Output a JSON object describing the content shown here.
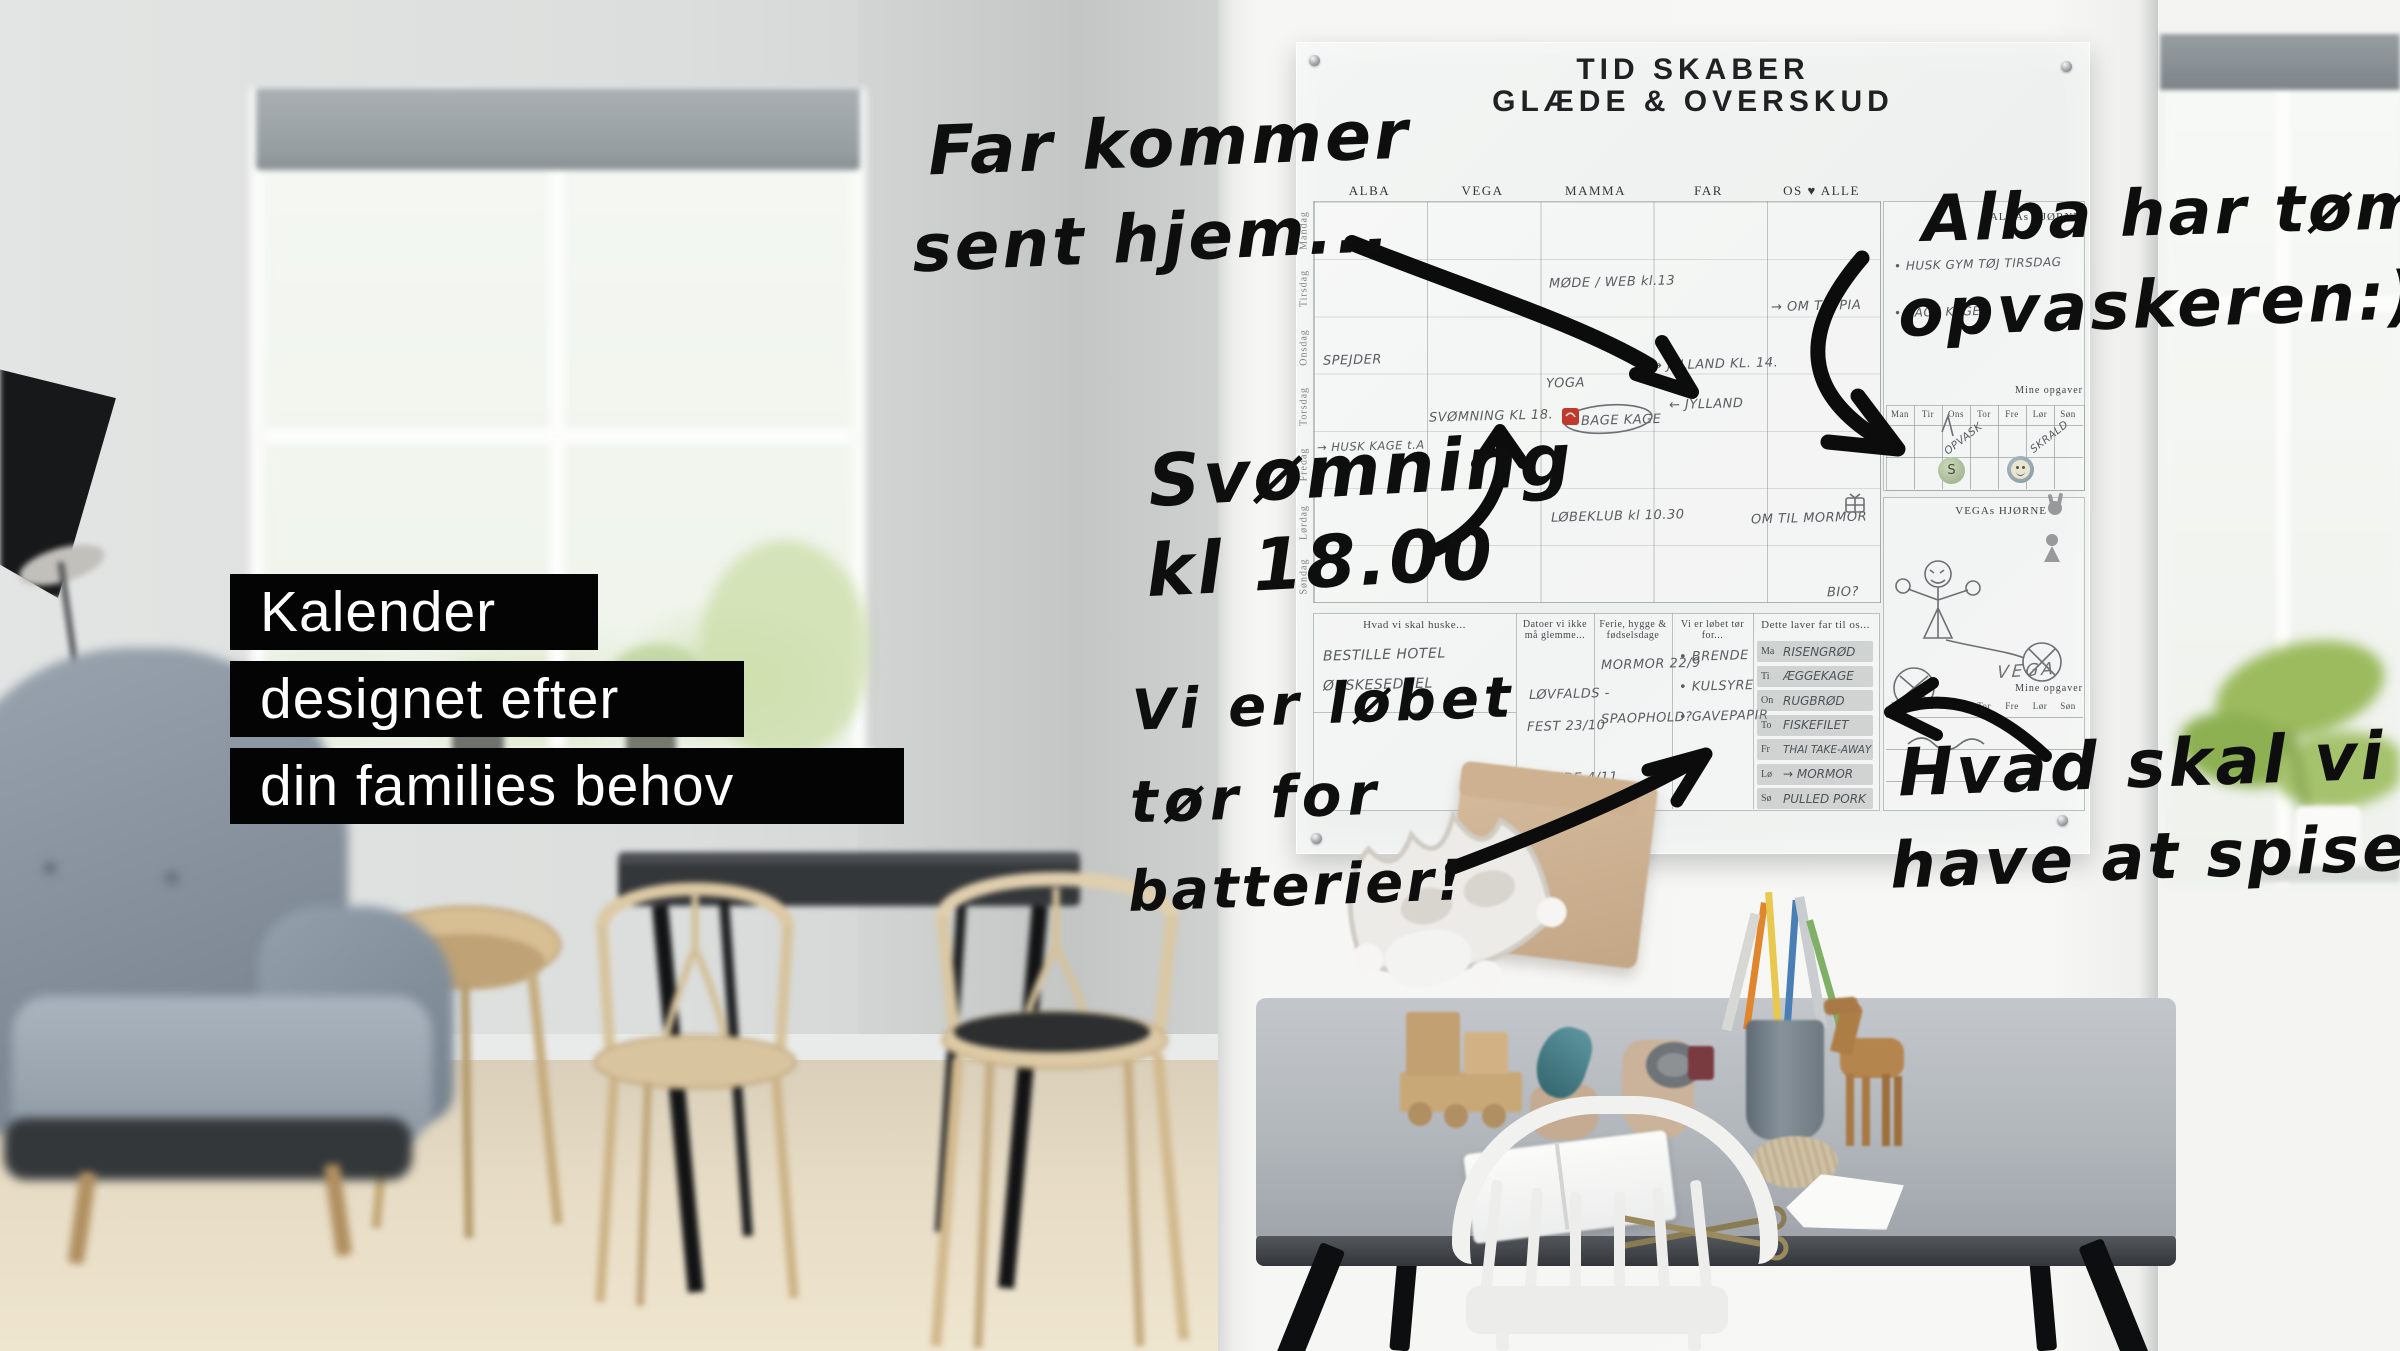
{
  "overlay": {
    "headline": [
      "Kalender",
      "designet efter",
      "din families behov"
    ]
  },
  "annotations": {
    "far": [
      "Far kommer",
      "sent hjem..."
    ],
    "alba": [
      "Alba har tømt",
      "opvaskeren:)"
    ],
    "svomning": [
      "Svømning",
      "kl 18.00"
    ],
    "batterier": [
      "Vi er løbet",
      "tør for",
      "batterier!"
    ],
    "spise": [
      "Hvad skal vi",
      "have at spise?"
    ]
  },
  "board": {
    "title": [
      "TID SKABER",
      "GLÆDE & OVERSKUD"
    ],
    "columns": [
      "ALBA",
      "VEGA",
      "MAMMA",
      "FAR",
      "OS ♥ ALLE"
    ],
    "days": [
      "Mandag",
      "Tirsdag",
      "Onsdag",
      "Torsdag",
      "Fredag",
      "Lørdag",
      "Søndag"
    ],
    "cells": {
      "mode_web": "MØDE / WEB kl.13",
      "om_til_pia": "→ OM TIL PIA",
      "spejder": "SPEJDER",
      "jylland_til": "→ JYLLAND KL. 14.",
      "yoga": "YOGA",
      "svomning": "SVØMNING KL 18.",
      "bage_kage": "BAGE KAGE",
      "jylland_fra": "← JYLLAND",
      "husk_kage": "→ HUSK KAGE t.A",
      "lobeklub": "LØBEKLUB kl 10.30",
      "om_til_mormor": "OM TIL MORMOR",
      "bio": "BIO?"
    },
    "alba_corner": {
      "title": "ALBAs HJØRNE",
      "notes": [
        "• HUSK GYM TØJ TIRSDAG",
        "• BAGE KAGE"
      ],
      "mini_label": "Mine opgaver",
      "mini_days": [
        "Man",
        "Tir",
        "Ons",
        "Tor",
        "Fre",
        "Lør",
        "Søn"
      ],
      "task_ons": "OPVASK",
      "task_lor": "SKRALD",
      "magnet_s": "S"
    },
    "vega_corner": {
      "title": "VEGAs HJØRNE",
      "scribble": "VEGA",
      "mini_label": "Mine opgaver",
      "mini_days": [
        "Man",
        "Tir",
        "Ons",
        "Tor",
        "Fre",
        "Lør",
        "Søn"
      ]
    },
    "footer": {
      "s1": {
        "header": "Hvad vi skal huske...",
        "items": [
          "BESTILLE HOTEL",
          "ØNSKESEDDEL"
        ]
      },
      "s2": {
        "header": "Datoer vi ikke må glemme...",
        "items": [
          "LØVFALDS -",
          "FEST 23/10",
          "F. MØDE 4/11"
        ]
      },
      "s3": {
        "header": "Ferie, hygge & fødselsdage",
        "items": [
          "MORMOR 22/9",
          "SPAOPHOLD?"
        ]
      },
      "s4": {
        "header": "Vi er løbet tør for...",
        "items": [
          "• BRENDE",
          "• KULSYRE",
          "• GAVEPAPIR"
        ]
      },
      "s5": {
        "header": "Dette laver far til os...",
        "days": [
          "Ma",
          "Ti",
          "On",
          "To",
          "Fr",
          "Lø",
          "Sø"
        ],
        "meals": [
          "RISENGRØD",
          "ÆGGEKAGE",
          "RUGBRØD",
          "FISKEFILET",
          "THAI TAKE-AWAY",
          "→ MORMOR",
          "PULLED PORK"
        ]
      }
    }
  },
  "colors": {
    "ink": "#0e0e0e",
    "overlay_bg": "#040404",
    "overlay_text": "#ffffff",
    "board_bg": "#f1f3f2",
    "pencil": "#585d61",
    "magnet_green": "#b9c9a8",
    "magnet_blue": "#8fa3ad",
    "sticker_red": "#c0392b"
  }
}
